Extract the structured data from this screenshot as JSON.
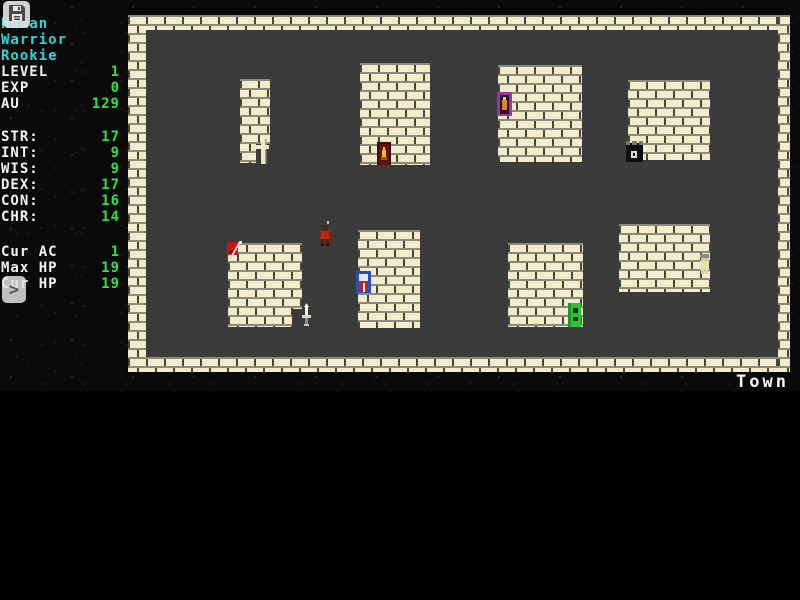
{
  "map": {
    "name": "Town",
    "icons": [
      "cross-icon",
      "flame-door-icon",
      "magic-door-icon",
      "tower-door-icon",
      "red-banner-icon",
      "dagger-icon",
      "shield-door-icon",
      "green-door-icon",
      "villager-icon",
      "player-icon"
    ],
    "colors": {
      "brick": "#f2ecca",
      "floor": "#3b3b3b",
      "background": "#0a0a0a"
    }
  },
  "sidebar": {
    "save_icon": "floppy-disk",
    "expand_button_label": ">",
    "character": {
      "race": "Human",
      "class": "Warrior",
      "title": "Rookie"
    },
    "progress": [
      {
        "label": "LEVEL",
        "value": "1"
      },
      {
        "label": "EXP",
        "value": "0"
      },
      {
        "label": "AU",
        "value": "129"
      }
    ],
    "attributes": [
      {
        "label": "STR:",
        "value": "17"
      },
      {
        "label": "INT:",
        "value": "9"
      },
      {
        "label": "WIS:",
        "value": "9"
      },
      {
        "label": "DEX:",
        "value": "17"
      },
      {
        "label": "CON:",
        "value": "16"
      },
      {
        "label": "CHR:",
        "value": "14"
      }
    ],
    "combat": [
      {
        "label": "Cur AC",
        "value": "1"
      },
      {
        "label": "Max HP",
        "value": "19"
      },
      {
        "label": "Cur HP",
        "value": "19"
      }
    ],
    "colors": {
      "label": "#f2f2f2",
      "value": "#2ee04a",
      "class_text": "#2fd6d6"
    }
  }
}
